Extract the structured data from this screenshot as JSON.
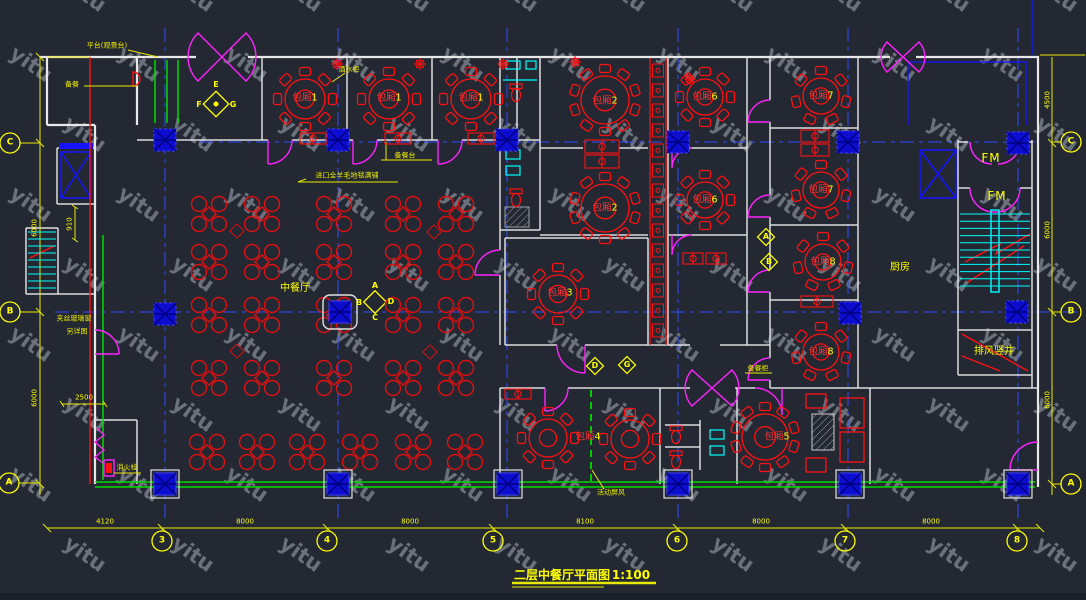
{
  "watermark": {
    "text": "yitu"
  },
  "title": {
    "text": "二层中餐厅平面图",
    "scale": "1:100"
  },
  "room_labels": {
    "bx1a": {
      "prefix": "包厢",
      "num": "1"
    },
    "bx1b": {
      "prefix": "包厢",
      "num": "1"
    },
    "bx1c": {
      "prefix": "包厢",
      "num": "1"
    },
    "bx2a": {
      "prefix": "包厢",
      "num": "2"
    },
    "bx2b": {
      "prefix": "包厢",
      "num": "2"
    },
    "bx3": {
      "prefix": "包厢",
      "num": "3"
    },
    "bx4": {
      "prefix": "包厢",
      "num": "4"
    },
    "bx5": {
      "prefix": "包厢",
      "num": "5"
    },
    "bx6a": {
      "prefix": "包厢",
      "num": "6"
    },
    "bx6b": {
      "prefix": "包厢",
      "num": "6"
    },
    "bx7a": {
      "prefix": "包厢",
      "num": "7"
    },
    "bx7b": {
      "prefix": "包厢",
      "num": "7"
    },
    "bx8a": {
      "prefix": "包厢",
      "num": "8"
    },
    "bx8b": {
      "prefix": "包厢",
      "num": "8"
    }
  },
  "area_labels": {
    "dining": "中餐厅",
    "kitchen": "厨房",
    "shaft": "排风竖井",
    "fm1": "FM",
    "fm2": "FM"
  },
  "annotations": {
    "platform": "平台(观景台)",
    "pantry": "备餐",
    "wine": "酒水柜",
    "service": "备餐台",
    "carpet": "进口全羊毛地毯满铺",
    "hydrant": "消火栓",
    "screen": "活动屏风",
    "glass1": "夹丝玻璃窗",
    "glass2": "另详图",
    "cabinet": "备餐柜"
  },
  "dimensions": {
    "bottom": [
      "4120",
      "8000",
      "8000",
      "8100",
      "8000",
      "8000"
    ],
    "left": [
      "6000",
      "6000"
    ],
    "right": [
      "4500",
      "6000",
      "6000"
    ],
    "d910": "910",
    "d2500": "2500"
  },
  "grid": {
    "left": [
      "C",
      "B",
      "A"
    ],
    "right": [
      "C",
      "B",
      "A"
    ],
    "bottom": [
      "3",
      "4",
      "5",
      "6",
      "7",
      "8"
    ]
  },
  "elev_markers": {
    "efg": [
      "E",
      "F",
      "G"
    ],
    "abcd": [
      "A",
      "B",
      "C",
      "D"
    ],
    "a": "A",
    "b": "B",
    "d": "D",
    "g": "G"
  },
  "colors": {
    "background": "#232833",
    "wall_white": "#e8e8e8",
    "line_red": "#ff1111",
    "line_yellow": "#ffff00",
    "line_magenta": "#ff22ff",
    "line_cyan": "#00ffff",
    "line_green": "#00dc00",
    "line_blue": "#1414ff",
    "watermark_gray": "#989ea8"
  }
}
